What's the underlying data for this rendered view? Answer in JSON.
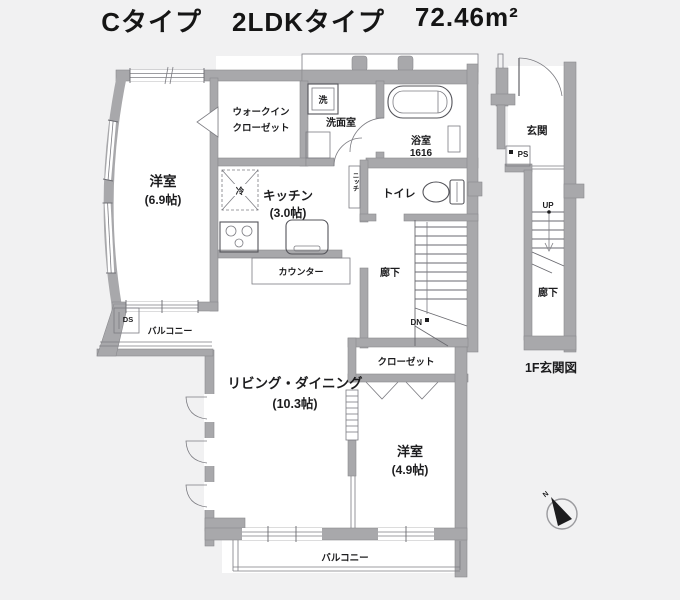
{
  "title": {
    "part1": "Cタイプ",
    "part2": "2LDKタイプ",
    "area": "72.46m²"
  },
  "colors": {
    "background": "#f1f1f2",
    "wall": "#a8a8ab",
    "line": "#54545a",
    "text": "#1c1c1e"
  },
  "main_plan": {
    "rooms": {
      "bedroom1": {
        "name": "洋室",
        "size": "(6.9帖)"
      },
      "wic": {
        "line1": "ウォークイン",
        "line2": "クローゼット"
      },
      "washroom": {
        "name": "洗面室"
      },
      "bathroom": {
        "name": "浴室",
        "size": "1616"
      },
      "kitchen": {
        "name": "キッチン",
        "size": "(3.0帖)"
      },
      "toilet": {
        "name": "トイレ"
      },
      "hallway": {
        "name": "廊下"
      },
      "living": {
        "name": "リビング・ダイニング",
        "size": "(10.3帖)"
      },
      "closet": {
        "name": "クローゼット"
      },
      "bedroom2": {
        "name": "洋室",
        "size": "(4.9帖)"
      },
      "balcony_side": {
        "name": "バルコニー"
      },
      "balcony_bottom": {
        "name": "バルコニー"
      },
      "counter": {
        "name": "カウンター"
      }
    },
    "fixtures": {
      "laundry": "洗",
      "fridge": "冷",
      "niche": "ニッチ",
      "duct": "DS",
      "down": "DN"
    }
  },
  "entrance_plan": {
    "genkan": "玄関",
    "ps": "PS",
    "up": "UP",
    "hallway": "廊下",
    "caption": "1F玄関図"
  },
  "compass": {
    "north": "N"
  }
}
